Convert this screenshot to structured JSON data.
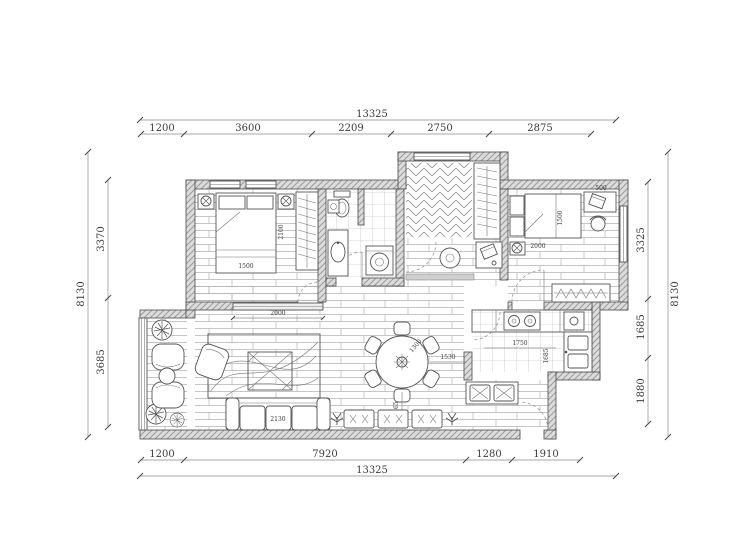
{
  "drawing": {
    "type": "residential floor plan",
    "units": "mm",
    "colors": {
      "background": "#ffffff",
      "line": "#4a4a4a",
      "wall_fill": "#dcdcdc",
      "hatch": "#9b9b9b",
      "dim_text": "#3c3c3c"
    }
  },
  "dimensions": {
    "top": {
      "overall": "13325",
      "segments": [
        "1200",
        "3600",
        "2209",
        "2750",
        "2875"
      ]
    },
    "bottom": {
      "overall": "13325",
      "segments": [
        "1200",
        "7920",
        "1280",
        "1910"
      ]
    },
    "left": {
      "overall": "8130",
      "segments": [
        "3370",
        "3685"
      ]
    },
    "right": {
      "overall": "8130",
      "segments": [
        "3325",
        "1685",
        "1880"
      ]
    }
  },
  "interior_labels": {
    "bed1_width": "1500",
    "bed1_length": "2100",
    "tv_console": "2000",
    "sofa_length": "2130",
    "dining_table": "1300",
    "dining_to_kitchen": "1530",
    "dining_walkway": "1465",
    "kitchen_counter": "1750",
    "kitchen_depth": "1685",
    "bed2_width": "1500",
    "bed2_length": "2000",
    "desk_depth": "500"
  }
}
